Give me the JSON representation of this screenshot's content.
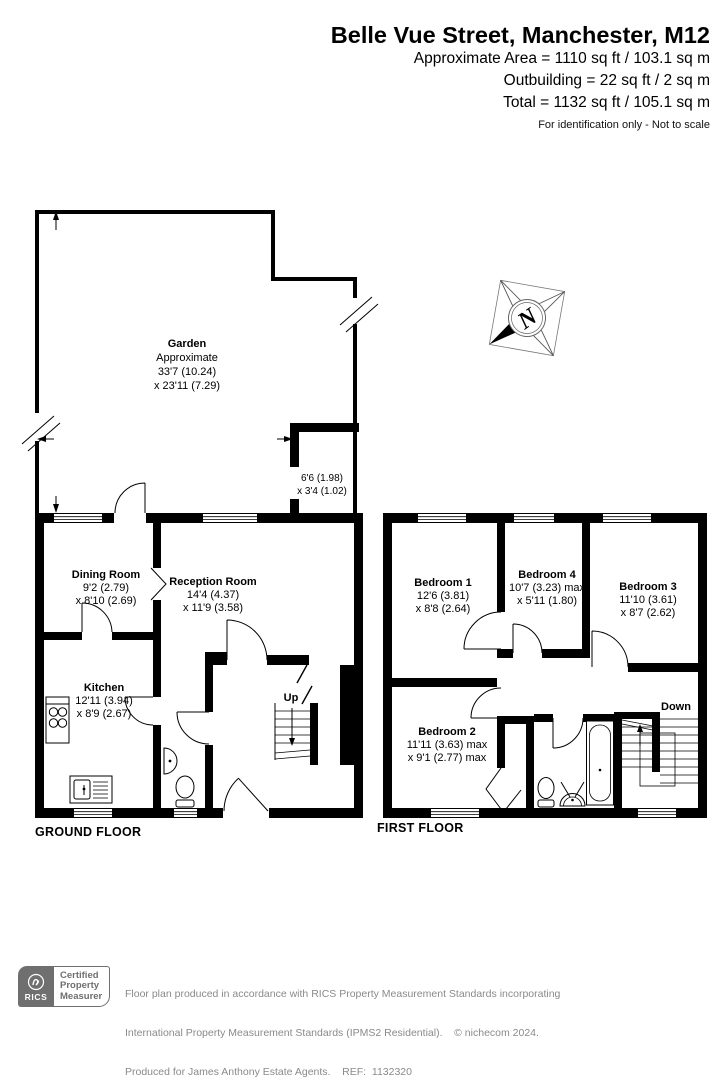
{
  "header": {
    "title": "Belle Vue Street, Manchester, M12",
    "area_line": "Approximate Area = 1110 sq ft / 103.1 sq m",
    "outbuilding_line": "Outbuilding = 22 sq ft / 2 sq m",
    "total_line": "Total = 1132 sq ft / 105.1 sq m",
    "disclaimer": "For identification only - Not to scale"
  },
  "compass": {
    "label": "N"
  },
  "ground_floor": {
    "floor_label": "GROUND FLOOR",
    "stairs_label": "Up",
    "garden": {
      "name": "Garden",
      "approx": "Approximate",
      "dim1": "33'7 (10.24)",
      "dim2": "x 23'11 (7.29)"
    },
    "outbuilding": {
      "dim1": "6'6 (1.98)",
      "dim2": "x 3'4 (1.02)"
    },
    "rooms": {
      "dining": {
        "name": "Dining Room",
        "dim1": "9'2 (2.79)",
        "dim2": "x 8'10 (2.69)"
      },
      "reception": {
        "name": "Reception Room",
        "dim1": "14'4 (4.37)",
        "dim2": "x 11'9 (3.58)"
      },
      "kitchen": {
        "name": "Kitchen",
        "dim1": "12'11 (3.94)",
        "dim2": "x 8'9 (2.67)"
      }
    }
  },
  "first_floor": {
    "floor_label": "FIRST FLOOR",
    "stairs_label": "Down",
    "rooms": {
      "bedroom1": {
        "name": "Bedroom 1",
        "dim1": "12'6 (3.81)",
        "dim2": "x 8'8 (2.64)"
      },
      "bedroom2": {
        "name": "Bedroom 2",
        "dim1": "11'11 (3.63) max",
        "dim2": "x 9'1 (2.77) max"
      },
      "bedroom3": {
        "name": "Bedroom 3",
        "dim1": "11'10 (3.61)",
        "dim2": "x 8'7 (2.62)"
      },
      "bedroom4": {
        "name": "Bedroom 4",
        "dim1": "10'7 (3.23) max",
        "dim2": "x 5'11 (1.80)"
      }
    }
  },
  "footer": {
    "rics_label": "RICS",
    "badge_line1": "Certified",
    "badge_line2": "Property",
    "badge_line3": "Measurer",
    "line1": "Floor plan produced in accordance with RICS Property Measurement Standards incorporating",
    "line2": "International Property Measurement Standards (IPMS2 Residential).    © nichecom 2024.",
    "line3": "Produced for James Anthony Estate Agents.    REF:  1132320"
  },
  "colors": {
    "wall": "#000000",
    "footer_text": "#8a8a8a",
    "badge_gray": "#6f6f6f"
  }
}
